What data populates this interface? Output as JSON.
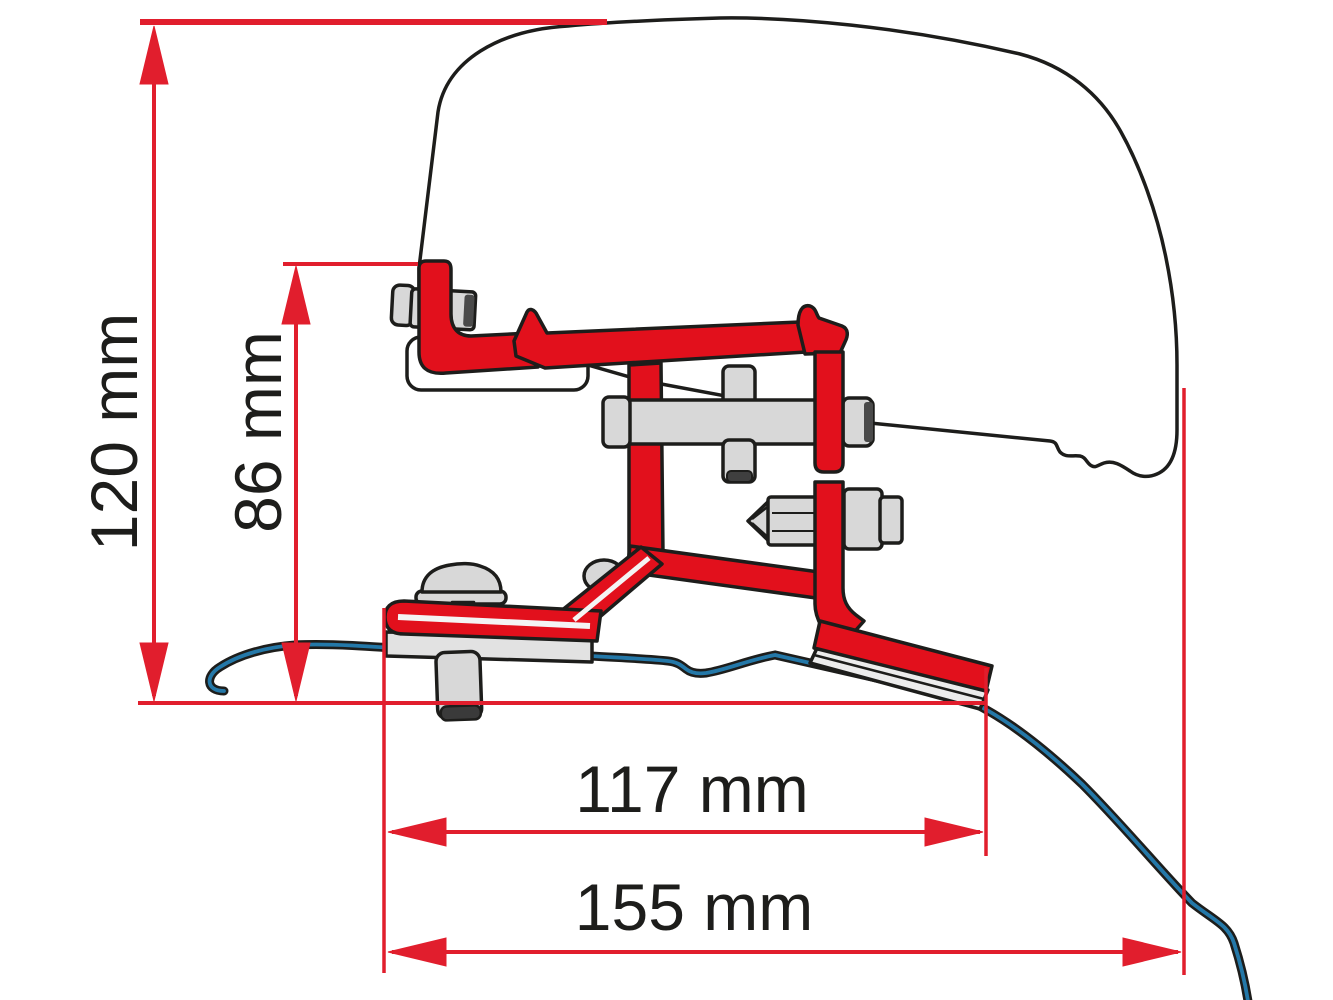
{
  "page": {
    "title": "Awning adapter bracket dimension diagram",
    "background": "#ffffff"
  },
  "diagram": {
    "type": "technical-drawing",
    "subject": "Side profile of awning case with red adapter bracket mounted on van roof",
    "dimensions": [
      {
        "label": "120 mm",
        "value": 120,
        "unit": "mm",
        "orientation": "vertical"
      },
      {
        "label": "86 mm",
        "value": 86,
        "unit": "mm",
        "orientation": "vertical"
      },
      {
        "label": "117 mm",
        "value": 117,
        "unit": "mm",
        "orientation": "horizontal"
      },
      {
        "label": "155 mm",
        "value": 155,
        "unit": "mm",
        "orientation": "horizontal"
      }
    ],
    "colors": {
      "dimension_red": "#e11e2d",
      "bracket_red": "#e2101c",
      "roof_blue": "#2478a8",
      "hardware_grey": "#d8d8d8",
      "outline_black": "#1d1d1b",
      "background": "#ffffff"
    }
  }
}
